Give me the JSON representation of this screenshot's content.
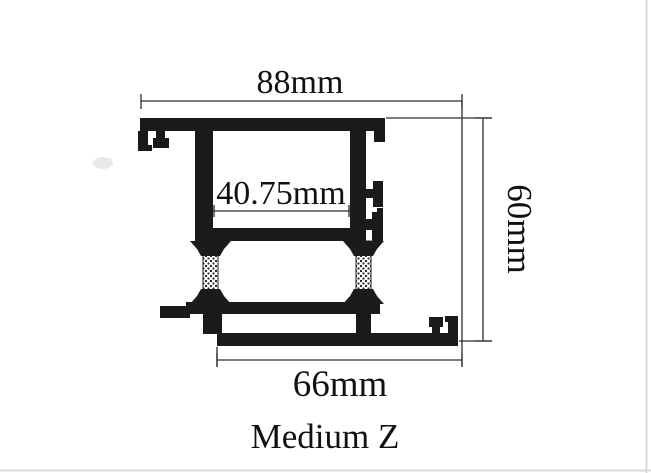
{
  "drawing": {
    "title": "Medium Z",
    "dimensions": {
      "top_width": "88mm",
      "inner_width": "40.75mm",
      "overall_height": "60mm",
      "bottom_width": "66mm"
    },
    "colors": {
      "ink": "#1b1b1b",
      "dimension_line": "#2e2e2e",
      "background": "#ffffff",
      "scan_edge": "#d9d9d9"
    }
  }
}
